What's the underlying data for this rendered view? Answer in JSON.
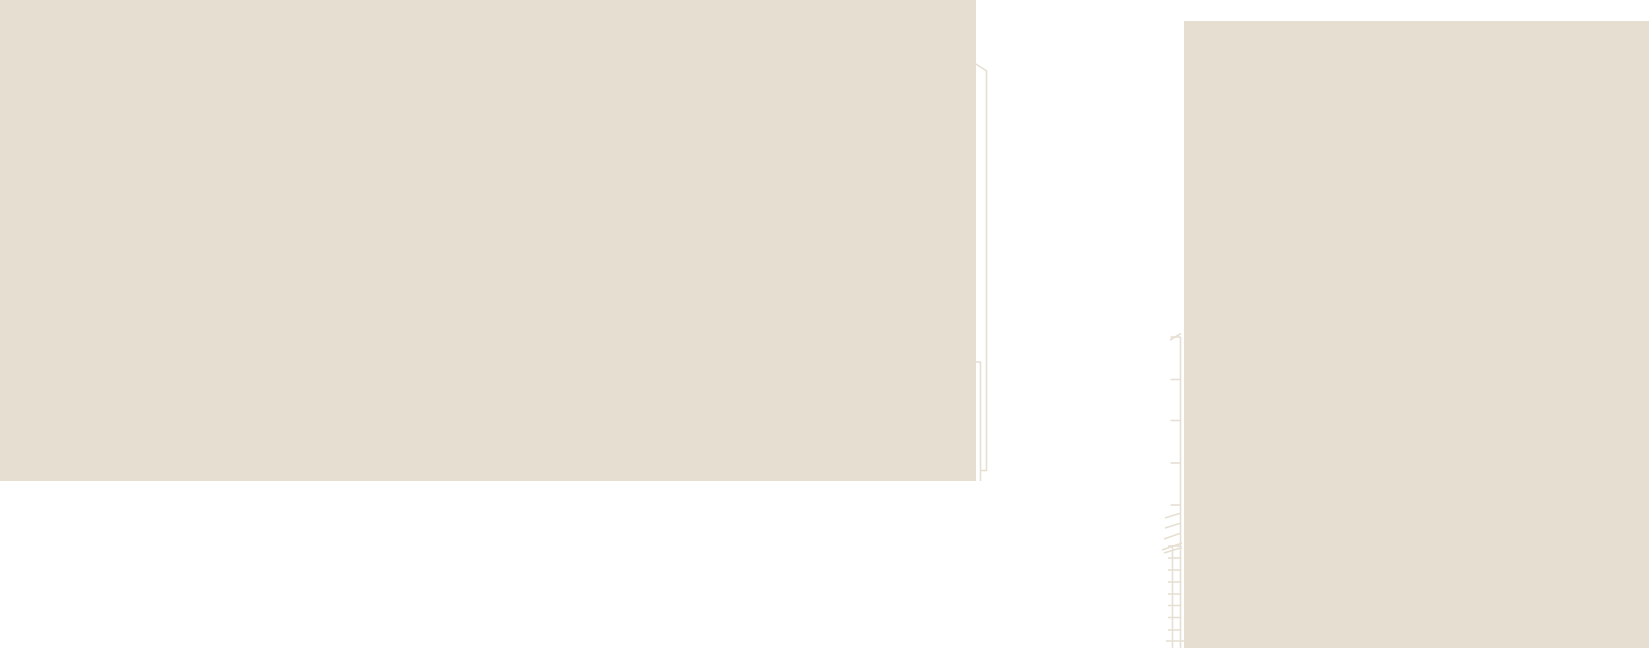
{
  "canvas": {
    "width": 1649,
    "height": 648,
    "background_color": "#ffffff"
  },
  "palette": {
    "block_fill": "#e5ded1",
    "line_color": "#e6dfd2"
  },
  "blocks": [
    {
      "name": "left-building-block",
      "x": 0,
      "y": 0,
      "width": 976,
      "height": 481
    },
    {
      "name": "right-building-block",
      "x": 1184,
      "y": 21,
      "width": 465,
      "height": 627
    }
  ],
  "downspout": {
    "stroke_width": 1.6,
    "segments": [
      {
        "name": "pipe-top-diagonal",
        "x1": 975,
        "y1": 63.5,
        "x2": 986,
        "y2": 70.5
      },
      {
        "name": "pipe-outer-vertical",
        "x1": 986.5,
        "y1": 70,
        "x2": 986.5,
        "y2": 471
      },
      {
        "name": "pipe-inner-vertical",
        "x1": 980.5,
        "y1": 362,
        "x2": 980.5,
        "y2": 481
      },
      {
        "name": "pipe-top-connector",
        "x1": 975.5,
        "y1": 362,
        "x2": 981,
        "y2": 362
      },
      {
        "name": "pipe-bottom-connector",
        "x1": 980,
        "y1": 470.5,
        "x2": 987,
        "y2": 470.5
      }
    ]
  },
  "ladder": {
    "stroke_width": 1.6,
    "right_rail": {
      "name": "ladder-right-rail",
      "x": 1180.5,
      "y1": 337,
      "y2": 648
    },
    "left_rail": {
      "name": "ladder-left-rail",
      "x": 1172.5,
      "y1": 545,
      "y2": 648
    },
    "top_tick": {
      "name": "ladder-top-tick",
      "x1": 1170,
      "y1": 340,
      "x2": 1181,
      "y2": 333.5
    },
    "bracket_ticks": {
      "name": "ladder-bracket-tick",
      "x1": 1170.5,
      "x2": 1180.5,
      "y_values": [
        337,
        379.5,
        420.5,
        463,
        505
      ]
    },
    "hatches": [
      {
        "name": "ladder-hatch-stroke",
        "x1": 1181,
        "y1": 513,
        "x2": 1165,
        "y2": 518
      },
      {
        "name": "ladder-hatch-stroke",
        "x1": 1181,
        "y1": 523,
        "x2": 1165,
        "y2": 528
      },
      {
        "name": "ladder-hatch-stroke",
        "x1": 1181,
        "y1": 533,
        "x2": 1164,
        "y2": 539
      },
      {
        "name": "ladder-hatch-stroke",
        "x1": 1182,
        "y1": 543,
        "x2": 1162,
        "y2": 550
      },
      {
        "name": "ladder-hatch-stroke",
        "x1": 1182,
        "y1": 547.5,
        "x2": 1164,
        "y2": 553
      }
    ],
    "rungs": {
      "name": "ladder-rung",
      "x1": 1168,
      "x2": 1181.5,
      "y_values": [
        546,
        558,
        570,
        582,
        594,
        605.5,
        617.5,
        630
      ]
    },
    "bottom_rung": {
      "name": "ladder-bottom-rung",
      "x1": 1166,
      "y1": 641,
      "x2": 1184,
      "y2": 641
    }
  }
}
